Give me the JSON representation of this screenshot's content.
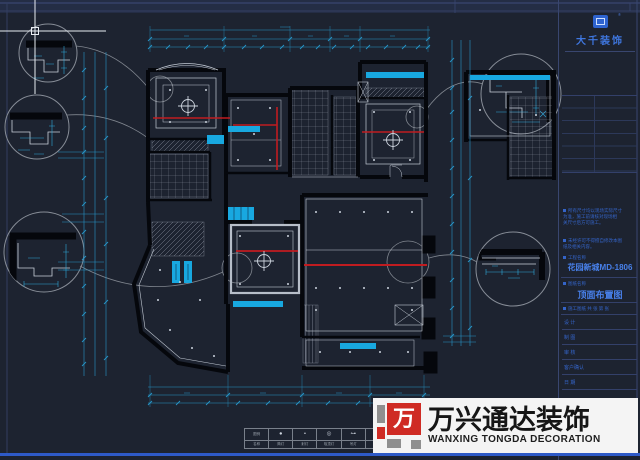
{
  "app": {
    "type": "cad-ceiling-plan-drawing"
  },
  "colors": {
    "background": "#1d2330",
    "dim_cyan": "#2795c8",
    "bright_cyan": "#18a8e0",
    "accent_red": "#c01c20",
    "wall_black": "#05070c",
    "blue_text": "#3a6fd8",
    "border_blue": "#2e5ac8",
    "logo_red": "#cf2b24"
  },
  "title_block": {
    "brand_cn": "大千装饰",
    "brand_reg": "®",
    "notes1": "所有尺寸均以现场实际尺寸\n为准，施工前请核对现场相\n关尺寸后方可施工。",
    "notes2": "未经许可不得擅自修改本图\n纸及相关内容。",
    "project_label": "工程名称",
    "project_name": "花园新城MD-1806",
    "drawing_label": "图纸名称",
    "drawing_name": "顶面布置图",
    "extra_label": "施工图纸  共 张 第 张",
    "rows": [
      {
        "label": "设 计"
      },
      {
        "label": "制 图"
      },
      {
        "label": "审 核"
      },
      {
        "label": "客户确认"
      },
      {
        "label": "日 期"
      }
    ]
  },
  "legend": {
    "items": [
      {
        "symbol": "图例",
        "label": "名称"
      },
      {
        "symbol": "●",
        "label": "筒灯"
      },
      {
        "symbol": "•",
        "label": "射灯"
      },
      {
        "symbol": "◎",
        "label": "吸顶灯"
      },
      {
        "symbol": "⊶",
        "label": "吊灯"
      },
      {
        "symbol": "⊞",
        "label": "浴霸"
      }
    ]
  },
  "watermark": {
    "cn": "万兴通达装饰",
    "en": "WANXING TONGDA DECORATION"
  }
}
